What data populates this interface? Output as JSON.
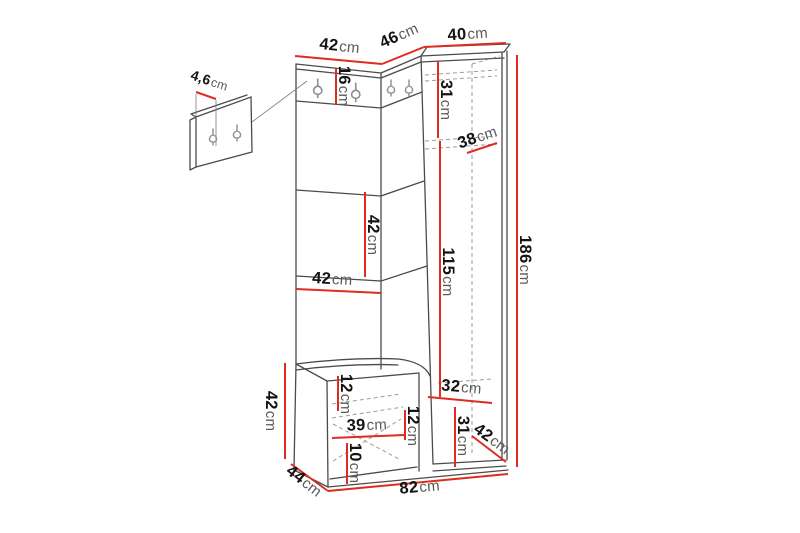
{
  "page": {
    "background": "#ffffff",
    "description": "Hallway furniture set dimension diagram"
  },
  "colors": {
    "dimension_line": "#e02b20",
    "outline": "#4b4b4b",
    "hidden_line": "#9c9c9c"
  },
  "dimensions": {
    "top_left_width": {
      "value": "42",
      "unit": "cm"
    },
    "top_corner_width": {
      "value": "46",
      "unit": "cm"
    },
    "top_right_width": {
      "value": "40",
      "unit": "cm"
    },
    "hook_panel_depth": {
      "value": "4,6",
      "unit": "cm"
    },
    "hook_panel_height": {
      "value": "16",
      "unit": "cm"
    },
    "wardrobe_top_section_height": {
      "value": "31",
      "unit": "cm"
    },
    "wardrobe_depth_top": {
      "value": "38",
      "unit": "cm"
    },
    "left_section_height": {
      "value": "42",
      "unit": "cm"
    },
    "left_section_width": {
      "value": "42",
      "unit": "cm"
    },
    "wardrobe_middle_height": {
      "value": "115",
      "unit": "cm"
    },
    "total_height": {
      "value": "186",
      "unit": "cm"
    },
    "bench_height": {
      "value": "42",
      "unit": "cm"
    },
    "bench_top_gap": {
      "value": "12",
      "unit": "cm"
    },
    "bench_inner_width": {
      "value": "39",
      "unit": "cm"
    },
    "bench_shelf_gap": {
      "value": "12",
      "unit": "cm"
    },
    "bench_bottom_gap": {
      "value": "10",
      "unit": "cm"
    },
    "wardrobe_inner_width": {
      "value": "32",
      "unit": "cm"
    },
    "wardrobe_bottom_section_height": {
      "value": "31",
      "unit": "cm"
    },
    "wardrobe_depth_bottom": {
      "value": "42",
      "unit": "cm"
    },
    "bench_depth": {
      "value": "44",
      "unit": "cm"
    },
    "total_width": {
      "value": "82",
      "unit": "cm"
    }
  }
}
